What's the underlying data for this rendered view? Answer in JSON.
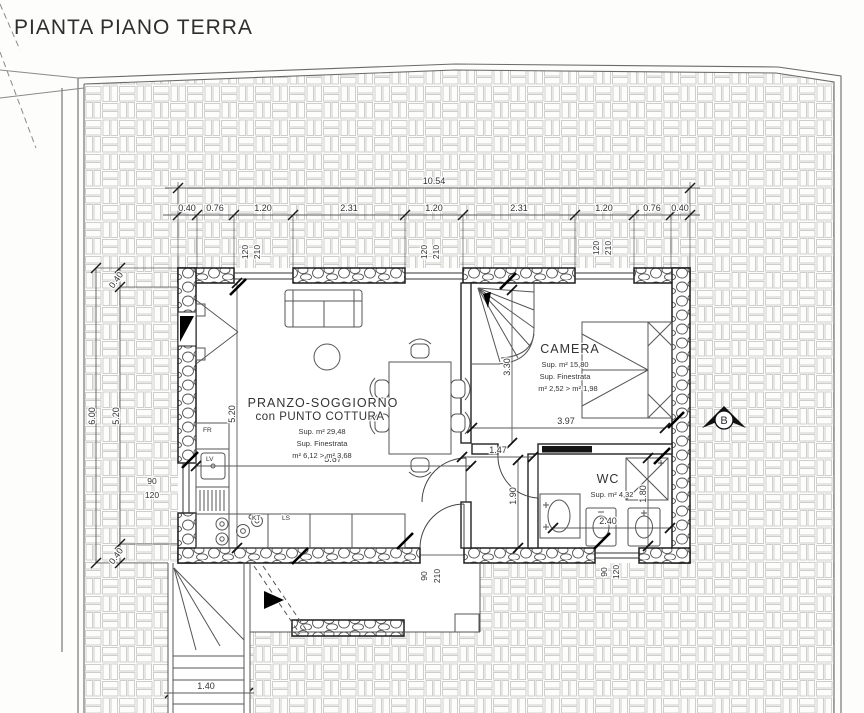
{
  "title": "PIANTA PIANO TERRA",
  "rooms": {
    "living": {
      "name": "PRANZO-SOGGIORNO",
      "name2": "con PUNTO COTTURA",
      "area": "Sup. m² 29,48",
      "fen_label": "Sup. Finestrata",
      "fen_values": "m² 6,12 > m² 3,68"
    },
    "camera": {
      "name": "CAMERA",
      "area": "Sup. m² 15,80",
      "fen_label": "Sup. Finestrata",
      "fen_values": "m² 2,52 > m² 1,98"
    },
    "wc": {
      "name": "WC",
      "area": "Sup. m² 4,32"
    }
  },
  "kitchen_labels": {
    "fr": "FR",
    "lv": "LV",
    "kt": "KT",
    "ls": "LS"
  },
  "dims": {
    "total_width": "10.54",
    "top_chain": [
      "0.40",
      "0.76",
      "1.20",
      "2.31",
      "1.20",
      "2.31",
      "1.20",
      "0.76",
      "0.40"
    ],
    "left_total": "6.00",
    "left_chain": [
      "0.40",
      "5.20",
      "0.40"
    ],
    "living_width": "5.67",
    "living_height": "5.20",
    "camera_width": "3.97",
    "camera_height": "3.30",
    "corridor": "1.47",
    "hall": "1.90",
    "wc_width": "2.40",
    "wc_height": "1.80",
    "stair_width": "1.40"
  },
  "openings": {
    "window_top": {
      "w": "120",
      "h": "210"
    },
    "window_left": {
      "w": "90",
      "h": "120"
    },
    "door_south": {
      "w": "90",
      "h": "210"
    },
    "window_south": {
      "w": "90",
      "h": "120"
    }
  },
  "markers": {
    "section": "B"
  }
}
